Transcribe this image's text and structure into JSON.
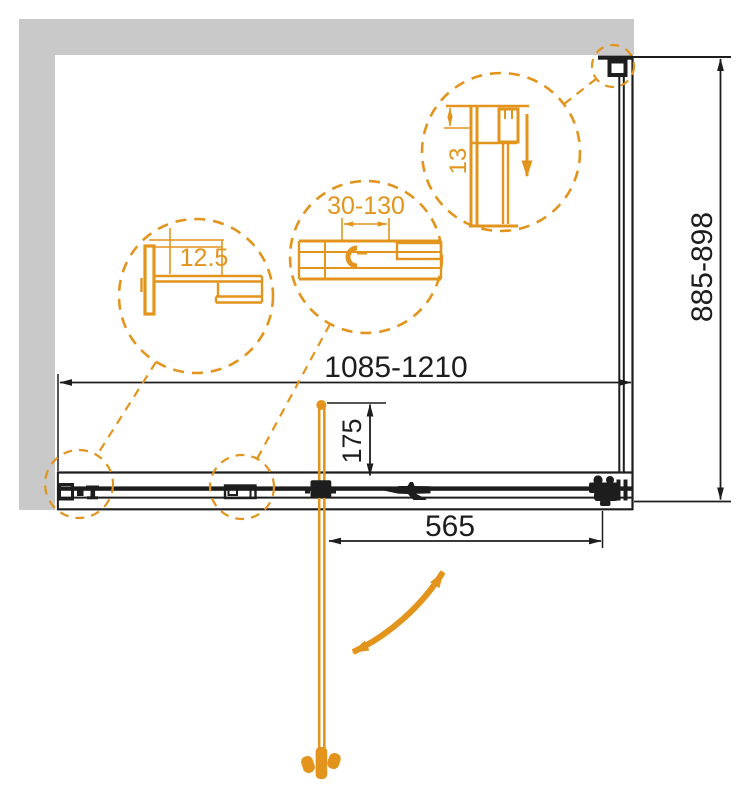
{
  "drawing": {
    "dimensions": {
      "overall_width": "1085-1210",
      "overall_depth": "885-898",
      "pivot_offset": "175",
      "door_width": "565"
    },
    "callouts": {
      "left_profile": "12.5",
      "adjustment_range": "30-130",
      "bracket_size": "13"
    },
    "colors": {
      "accent": "#E2941D",
      "wall": "#C9C9C9",
      "line": "#1D1D1D"
    }
  }
}
